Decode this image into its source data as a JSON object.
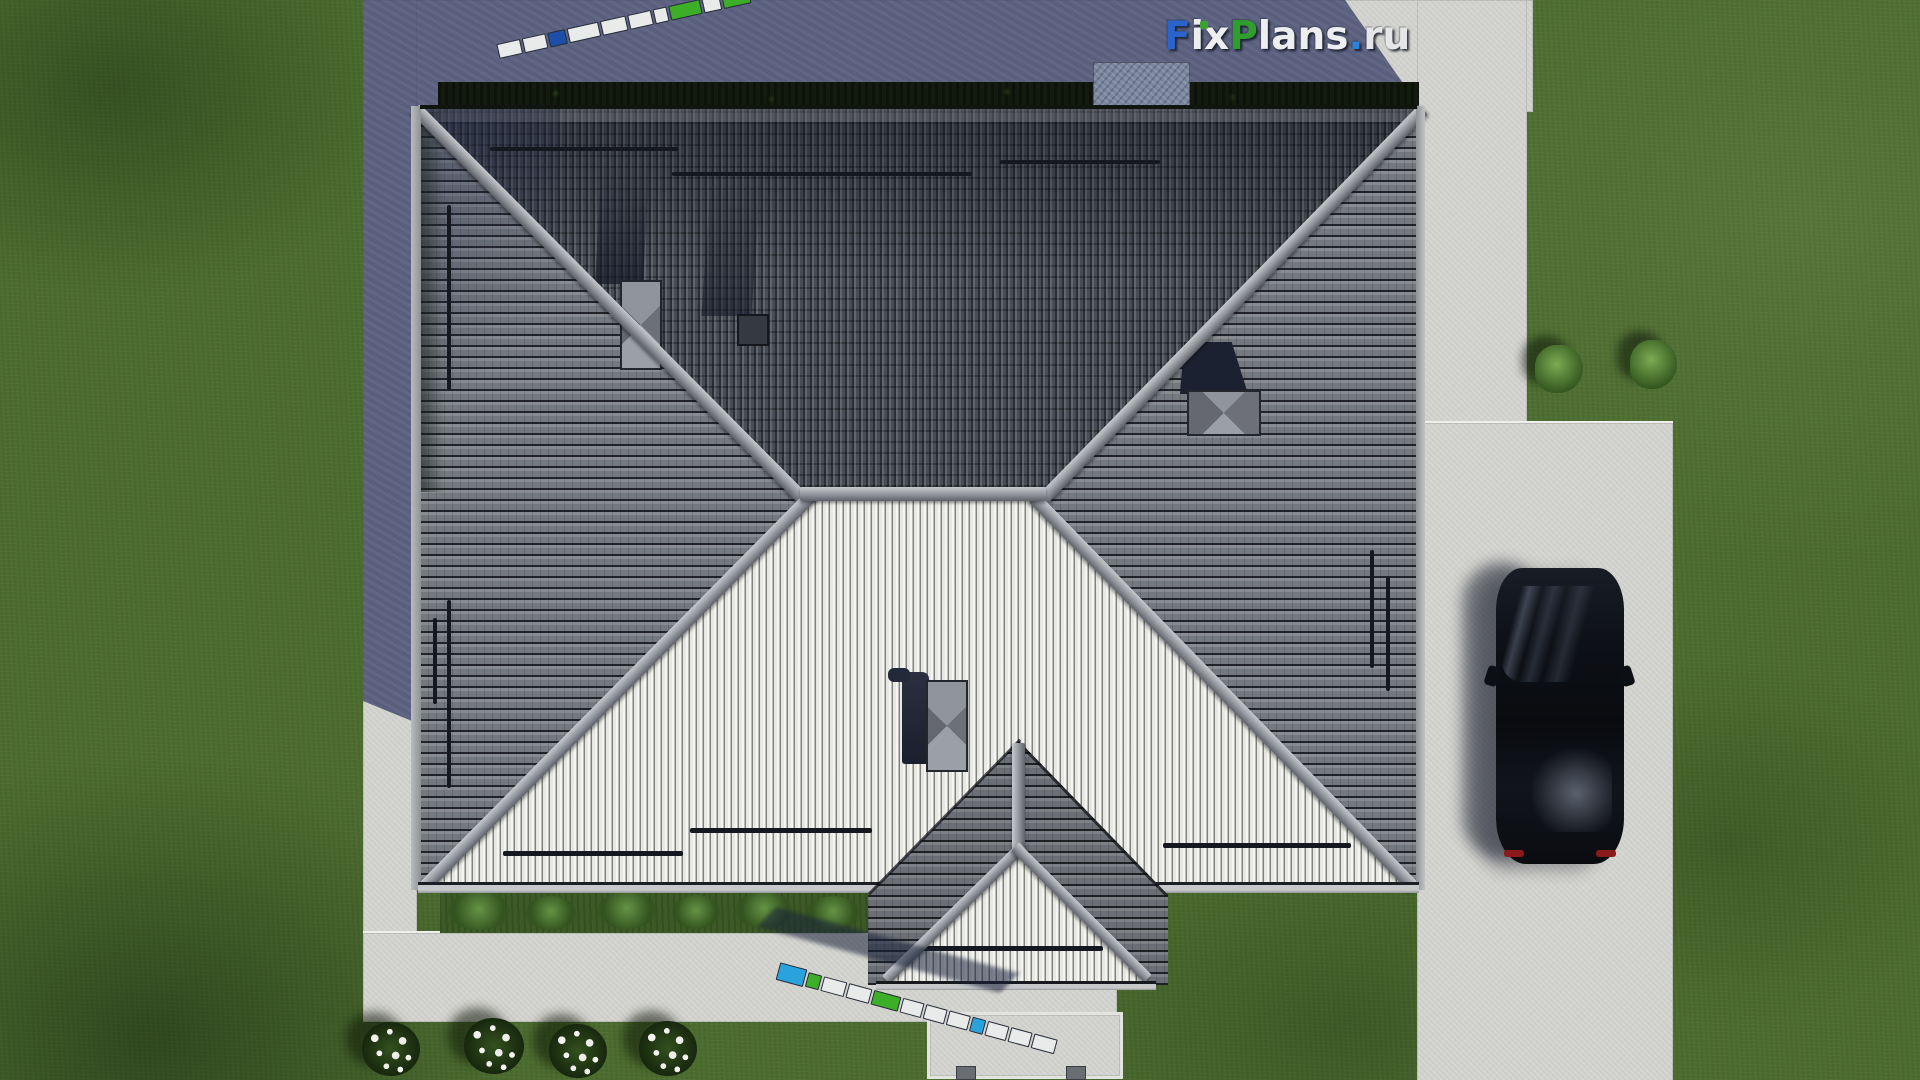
{
  "brand": {
    "full_text": "FixPlans.ru",
    "part_f": "F",
    "part_ix": "ix",
    "part_p": "P",
    "part_lans": "lans",
    "part_dot": ".",
    "part_ru": "ru",
    "color_f": "#2a63cc",
    "color_p": "#2f9e2f",
    "color_dot": "#2b82d9",
    "color_text": "#eceef0",
    "color_i_tittle": "#3aa233"
  },
  "scene": {
    "description_objects": [
      "hip-roof-house-top-view",
      "dark-upper-roof-slopes",
      "light-front-roof-slope",
      "porch-gable-roof",
      "chimney",
      "roof-vent",
      "snow-guard-rails",
      "perimeter-hedge",
      "concrete-paths",
      "driveway",
      "black-car",
      "folding-ruler-top",
      "folding-ruler-bottom",
      "flower-bushes",
      "round-bushes",
      "lawn",
      "building-shadow"
    ],
    "palette": {
      "grass": "#4c6d2f",
      "concrete": "#d4d4d0",
      "shadow_concrete": "#676f8f",
      "dark_roof": "#474c55",
      "side_roof": "#74797f",
      "light_roof": "#dededb",
      "ridge_cap": "#9aa0a6",
      "hedge": "#131b0e",
      "car_body": "#0a0c10",
      "ruler_blue": "#1d4fa8",
      "ruler_cyan": "#2aa3dc",
      "ruler_green": "#3cae28",
      "ruler_white": "#e9ebeb"
    }
  }
}
